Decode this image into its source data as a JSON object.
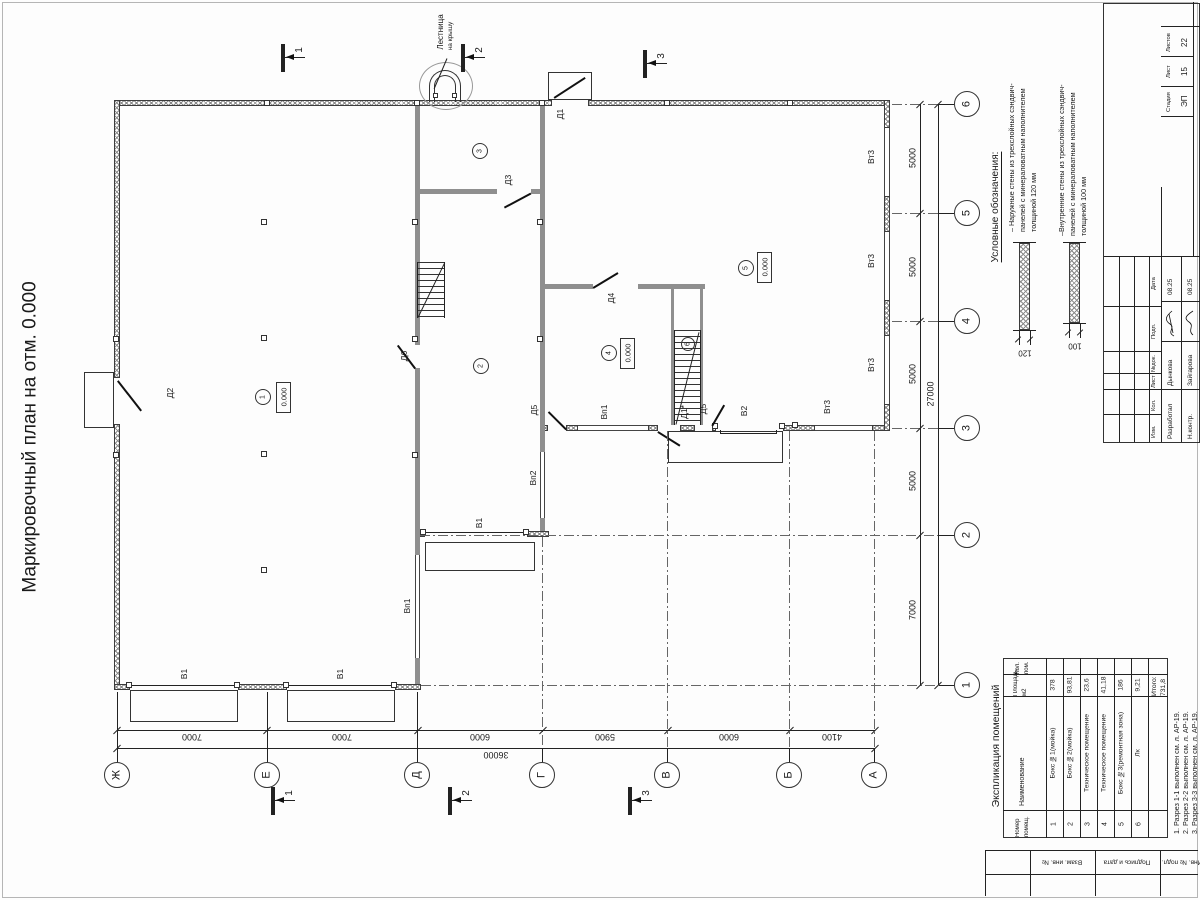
{
  "sheet": {
    "title": "Маркировочный план на отм. 0.000"
  },
  "plan": {
    "elev": "0.000",
    "room_nums": [
      "1",
      "2",
      "3",
      "4",
      "5",
      "6"
    ],
    "sections": [
      "1",
      "2",
      "3"
    ],
    "grid_cols": [
      "Ж",
      "Е",
      "Д",
      "Г",
      "В",
      "Б",
      "А"
    ],
    "grid_rows": [
      "6",
      "5",
      "4",
      "3",
      "2",
      "1"
    ],
    "dims_bottom": [
      "7000",
      "7000",
      "6000",
      "5900",
      "6000",
      "4100"
    ],
    "dims_bottom_total": "36000",
    "dim_right": "5000",
    "dim_right_last": "7000",
    "dims_right_total": "27000",
    "labels": {
      "d1": "Д1",
      "d2": "Д2",
      "d3": "Д3",
      "d4": "Д4",
      "d5": "Д5",
      "d6": "Д6",
      "d1s": "Д1*",
      "v1": "В1",
      "v2": "В2",
      "vp1": "Вп1",
      "vp2": "Вп2",
      "vt3": "Вт3"
    },
    "ladder": {
      "line1": "Лестница",
      "line2": "на крышу"
    }
  },
  "legend": {
    "heading": "Условные обозначения:",
    "item1": {
      "text": "– Наружные стены из трехслойных сэндвич-панелей с минераловатным наполнителем толщиной 120 мм",
      "dim": "120"
    },
    "item2": {
      "text": "–Внутренние стены из трехслойных сэндвич-панелей с минераловатным наполнителем толщиной 100 мм",
      "dim": "100"
    }
  },
  "room_table": {
    "title": "Экспликация помещений",
    "headers": {
      "num": "Номер помещ.",
      "name": "Наименование",
      "area": "Площадь, м2",
      "count": "Кол. пом."
    },
    "rows": [
      {
        "num": "1",
        "name": "Бокс №1(мойка)",
        "area": "378"
      },
      {
        "num": "2",
        "name": "Бокс №2(мойка)",
        "area": "93,81"
      },
      {
        "num": "3",
        "name": "Техническое помещение",
        "area": "23,6"
      },
      {
        "num": "4",
        "name": "Техническое помещение",
        "area": "41,18"
      },
      {
        "num": "5",
        "name": "Бокс №3(ремонтная зона)",
        "area": "186"
      },
      {
        "num": "6",
        "name": "Лк",
        "area": "9,21"
      }
    ],
    "total": "Итого: 731,8"
  },
  "notes": [
    "1. Разрез 1-1 выполнен см. л. АР-19.",
    "2. Разрез 2-2 выполнен см. л. АР-19.",
    "3. Разрез 3-3 выполнен см. л. АР-19."
  ],
  "title_block": {
    "rev_headers": [
      "Изм.",
      "Кол.",
      "Лист",
      "№док.",
      "Подп.",
      "Дата"
    ],
    "row1": {
      "role": "Разработал",
      "name": "Дынкова",
      "date": "08.25"
    },
    "row2": {
      "role": "Н.контр.",
      "name": "Зайгарова",
      "date": "08.25"
    },
    "stage_label": "Стадия",
    "sheet_label": "Лист",
    "sheets_label": "Листов",
    "stage": "ЭП",
    "sheet": "15",
    "sheets": "22"
  },
  "frame": {
    "s1": "Взам. инв. №",
    "s2": "Подпись и дата",
    "s3": "Инв. № подл."
  }
}
